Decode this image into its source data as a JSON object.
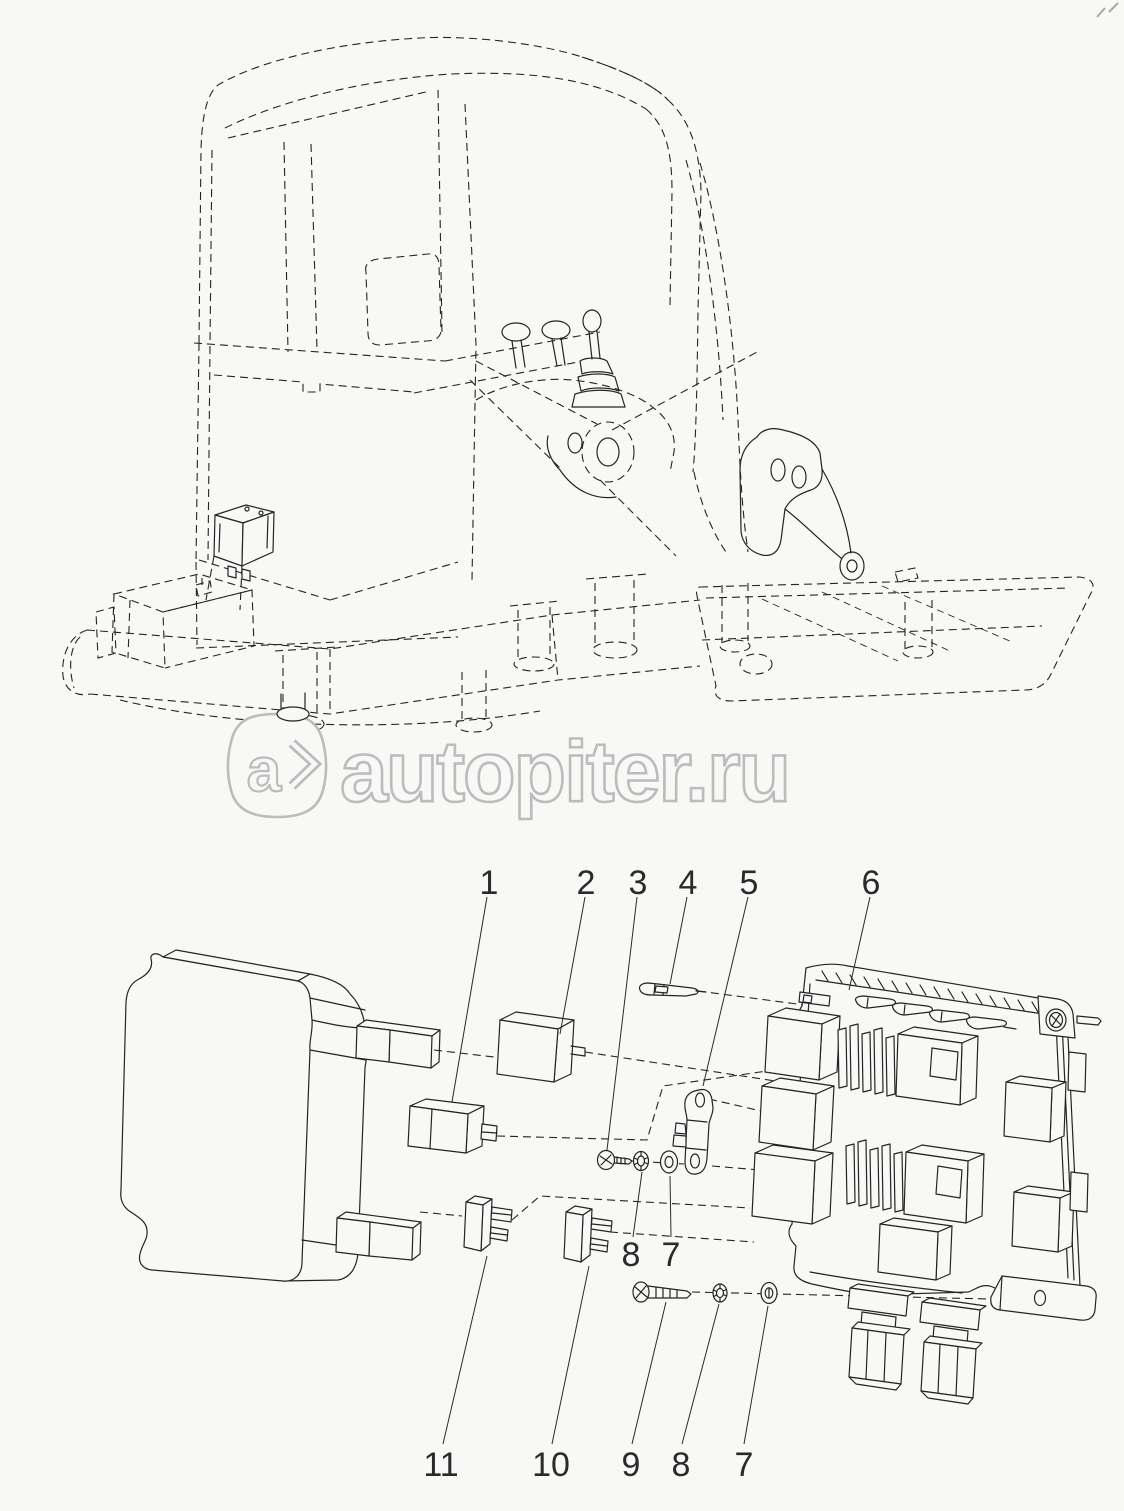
{
  "watermark": {
    "logo_letter": "a",
    "brand_text": "autopiter.ru"
  },
  "callouts": {
    "top": [
      "1",
      "2",
      "3",
      "4",
      "5",
      "6"
    ],
    "middle": [
      "8",
      "7"
    ],
    "bottom": [
      "11",
      "10",
      "9",
      "8",
      "7"
    ]
  },
  "colors": {
    "background": "#f8f8f6",
    "line": "#242424",
    "watermark": "#bcbcbc",
    "callout": "#2a2a2a"
  }
}
